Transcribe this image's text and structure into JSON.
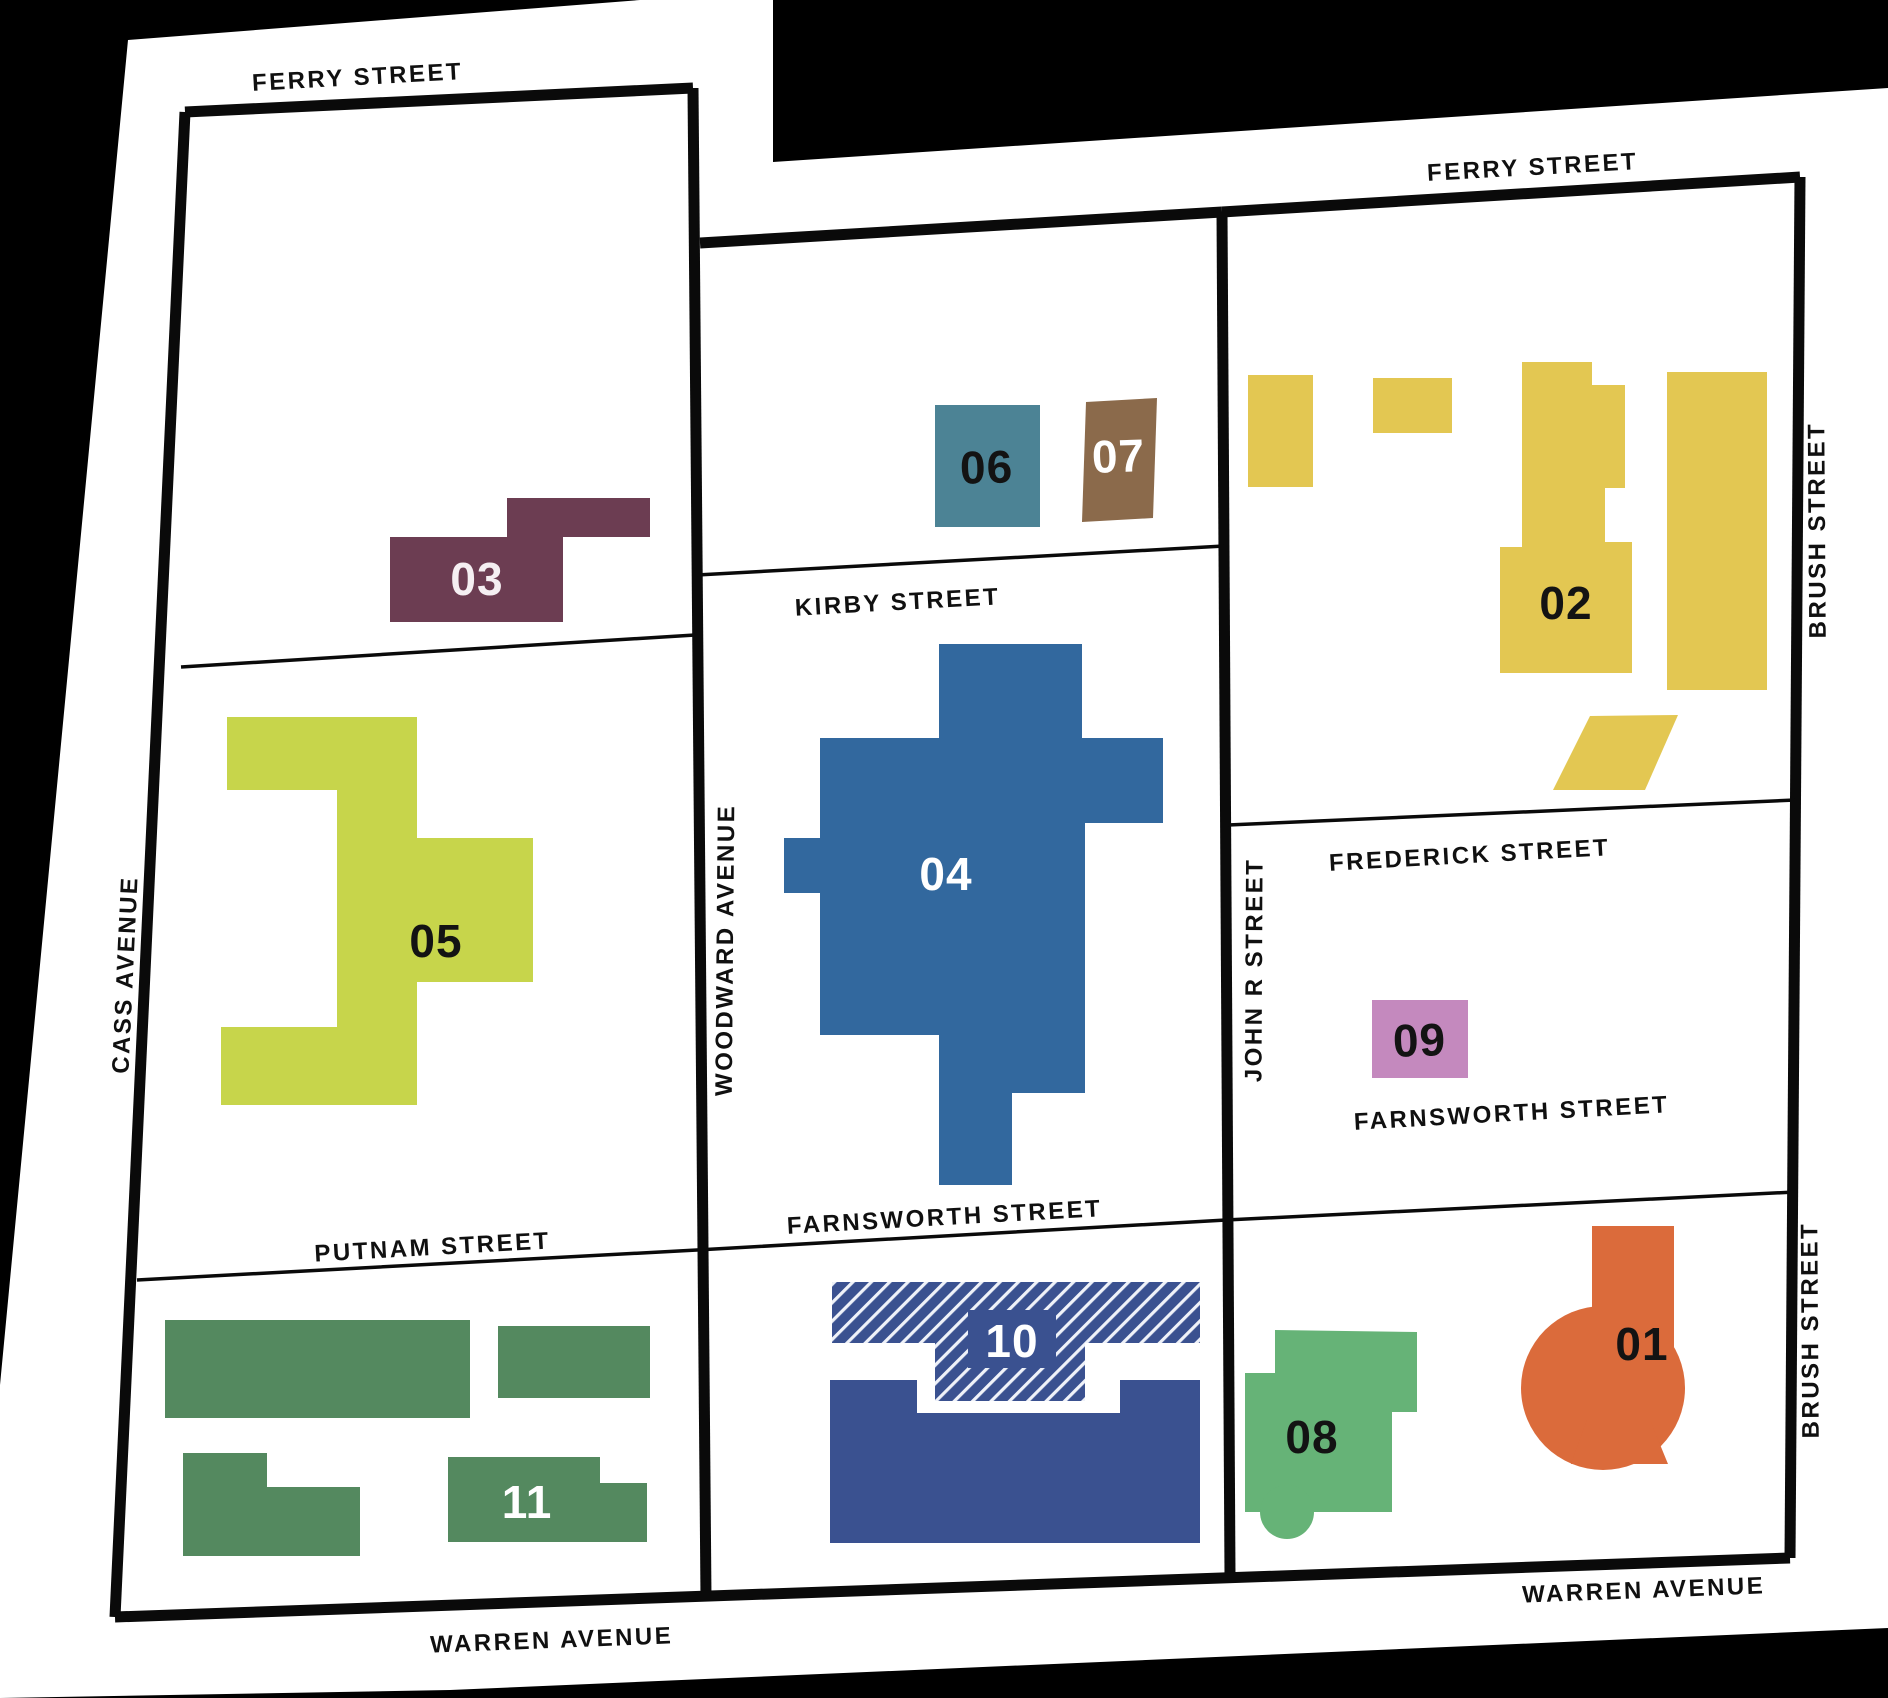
{
  "map": {
    "background": "#000000",
    "sheet": "#ffffff",
    "line": "#0a0a0a",
    "street_text": "#101010"
  },
  "streets": {
    "ferry_west": "FERRY STREET",
    "ferry_east": "FERRY STREET",
    "kirby": "KIRBY STREET",
    "frederick": "FREDERICK STREET",
    "farnsworth_mid": "FARNSWORTH STREET",
    "farnsworth_east": "FARNSWORTH STREET",
    "putnam": "PUTNAM STREET",
    "warren_west": "WARREN AVENUE",
    "warren_east": "WARREN AVENUE",
    "cass": "CASS AVENUE",
    "woodward": "WOODWARD AVENUE",
    "john_r": "JOHN R STREET",
    "brush_north": "BRUSH STREET",
    "brush_south": "BRUSH STREET"
  },
  "buildings": {
    "b01": {
      "number": "01",
      "color": "#DB6B3B",
      "label_color": "#131313"
    },
    "b02": {
      "number": "02",
      "color": "#E3C752",
      "label_color": "#131313"
    },
    "b03": {
      "number": "03",
      "color": "#6C3D52",
      "label_color": "#F5EFF2"
    },
    "b04": {
      "number": "04",
      "color": "#32689E",
      "label_color": "#FFFFFF"
    },
    "b05": {
      "number": "05",
      "color": "#C7D54B",
      "label_color": "#131313"
    },
    "b06": {
      "number": "06",
      "color": "#4C8395",
      "label_color": "#131313"
    },
    "b07": {
      "number": "07",
      "color": "#8B6A4B",
      "label_color": "#FFFFFF"
    },
    "b08": {
      "number": "08",
      "color": "#66B377",
      "label_color": "#131313"
    },
    "b09": {
      "number": "09",
      "color": "#C489BE",
      "label_color": "#131313"
    },
    "b10": {
      "number": "10",
      "color": "#3A5190",
      "hatch_stripe": "#EFF2F9",
      "label_color": "#FFFFFF"
    },
    "b11": {
      "number": "11",
      "color": "#54895F",
      "label_color": "#FFFFFF"
    }
  }
}
